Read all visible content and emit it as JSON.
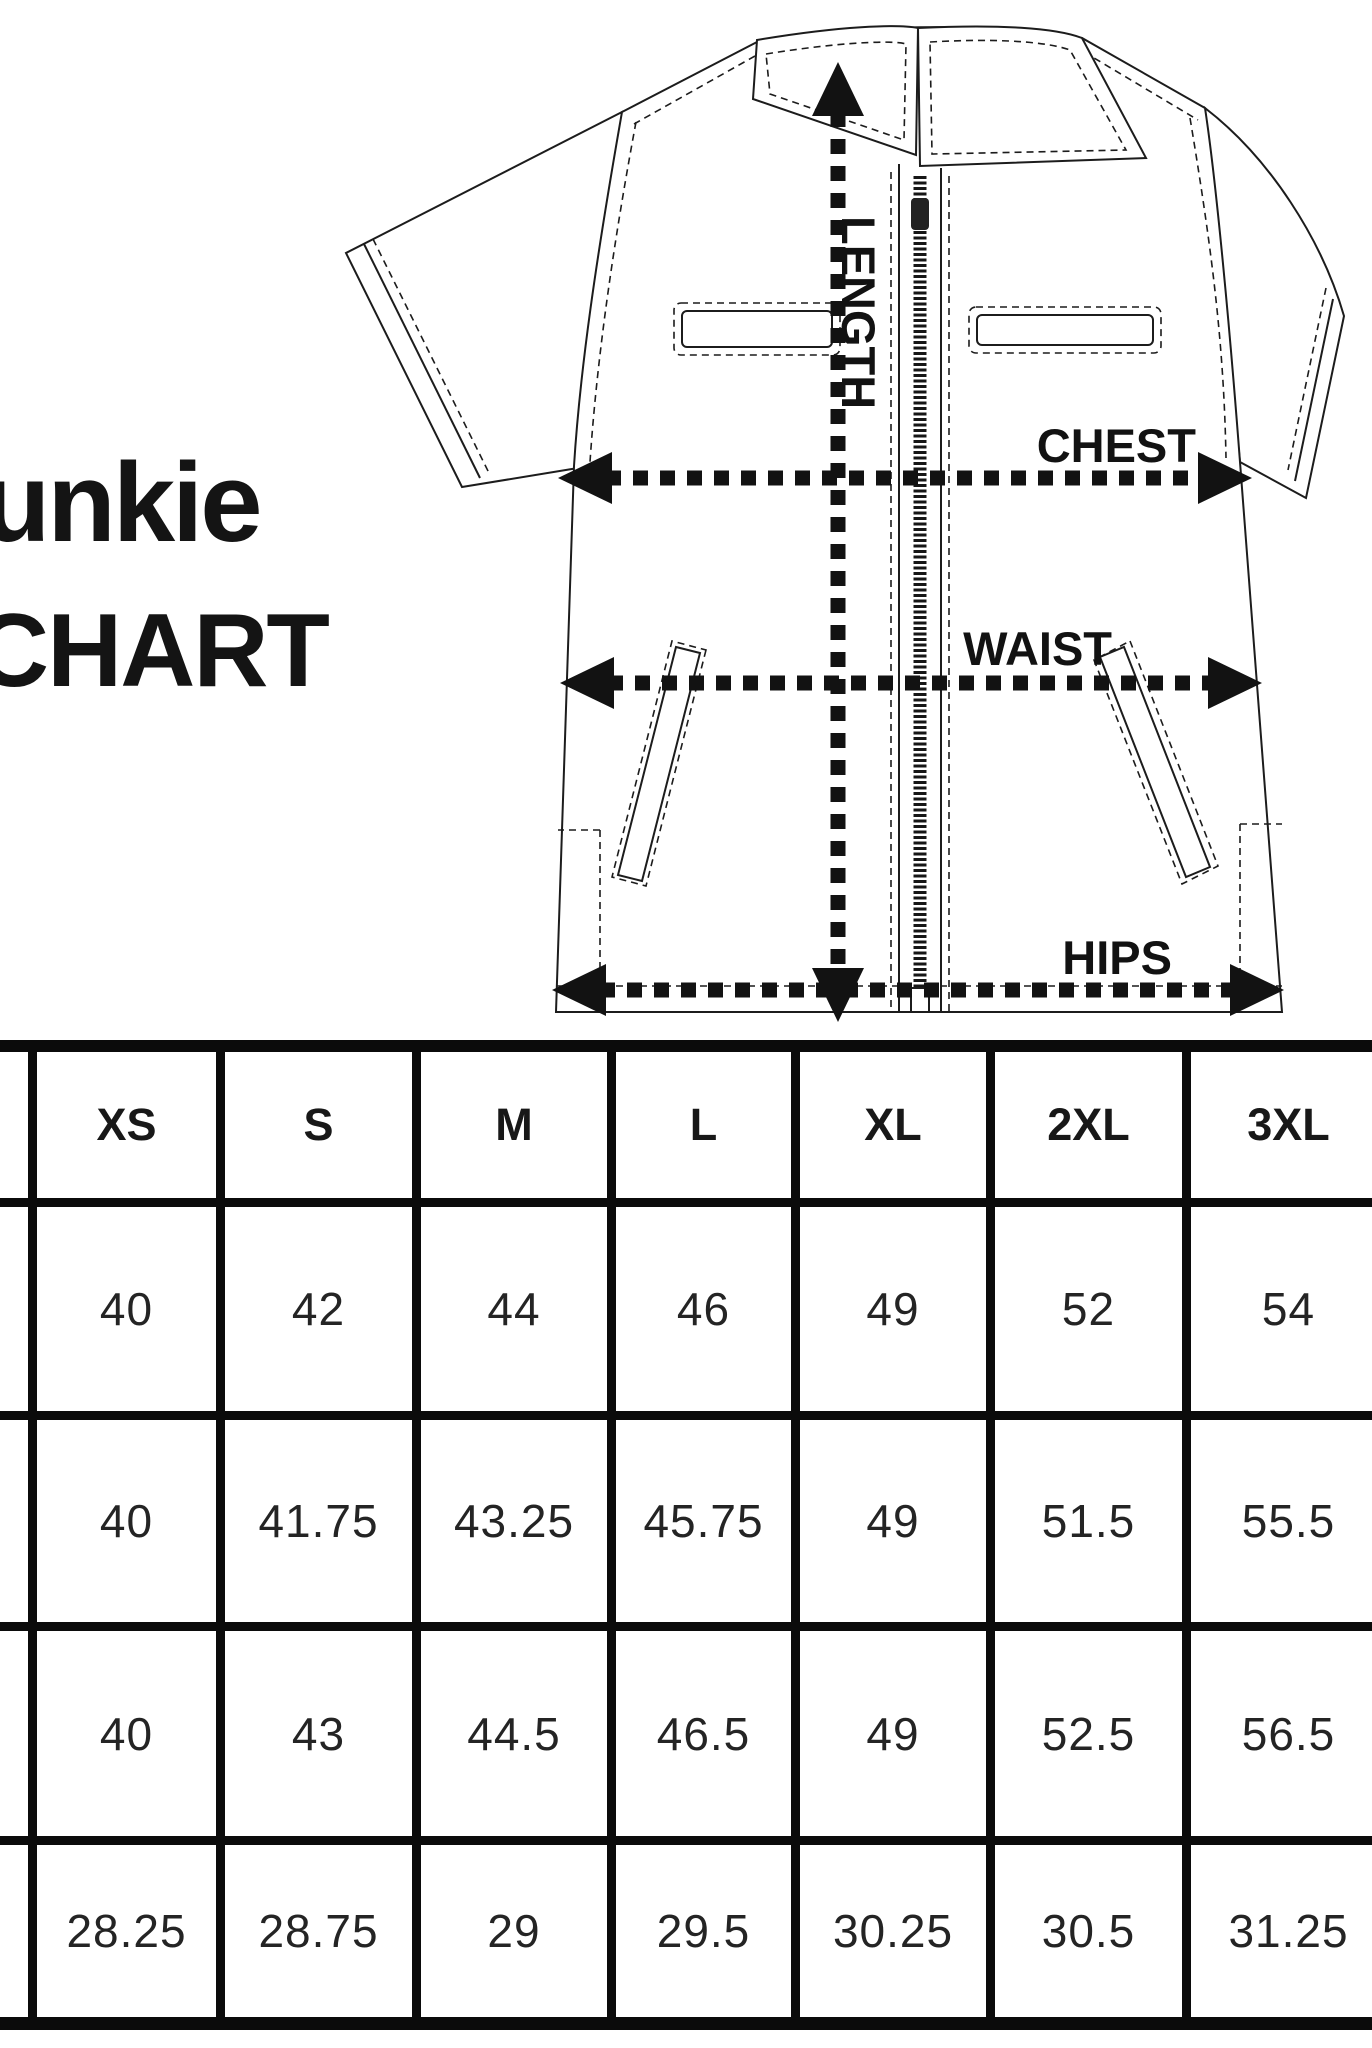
{
  "brand": {
    "line1": "unkie",
    "line2": "CHART"
  },
  "diagram": {
    "labels": {
      "length": "LENGTH",
      "chest": "CHEST",
      "waist": "WAIST",
      "hips": "HIPS"
    }
  },
  "table": {
    "headers": [
      "XS",
      "S",
      "M",
      "L",
      "XL",
      "2XL",
      "3XL"
    ],
    "rows": [
      [
        "40",
        "42",
        "44",
        "46",
        "49",
        "52",
        "54"
      ],
      [
        "40",
        "41.75",
        "43.25",
        "45.75",
        "49",
        "51.5",
        "55.5"
      ],
      [
        "40",
        "43",
        "44.5",
        "46.5",
        "49",
        "52.5",
        "56.5"
      ],
      [
        "28.25",
        "28.75",
        "29",
        "29.5",
        "30.25",
        "30.5",
        "31.25"
      ]
    ]
  },
  "chart_data": {
    "type": "table",
    "columns": [
      "XS",
      "S",
      "M",
      "L",
      "XL",
      "2XL",
      "3XL"
    ],
    "rows": [
      [
        40,
        42,
        44,
        46,
        49,
        52,
        54
      ],
      [
        40,
        41.75,
        43.25,
        45.75,
        49,
        51.5,
        55.5
      ],
      [
        40,
        43,
        44.5,
        46.5,
        49,
        52.5,
        56.5
      ],
      [
        28.25,
        28.75,
        29,
        29.5,
        30.25,
        30.5,
        31.25
      ]
    ],
    "title": "CHART",
    "annotations": [
      "LENGTH",
      "CHEST",
      "WAIST",
      "HIPS"
    ]
  }
}
